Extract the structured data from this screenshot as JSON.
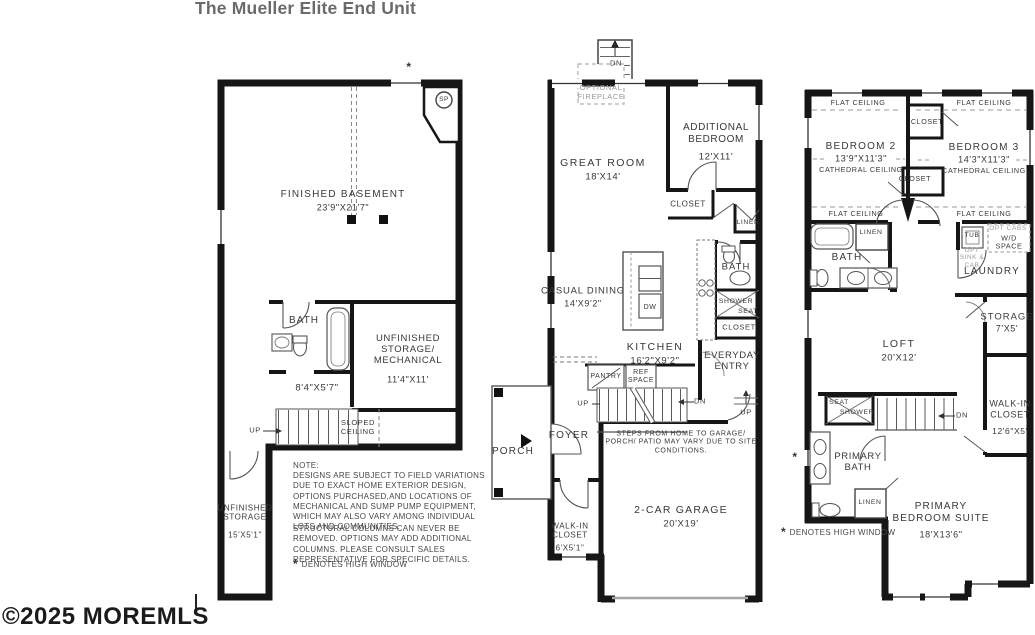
{
  "title": "The Mueller Elite End Unit",
  "watermark": "©2025 MOREMLS",
  "glyphs": {
    "arrow_right": "→",
    "arrow_left": "←",
    "arrow_up": "↑"
  },
  "colors": {
    "wall": "#161616",
    "label": "#383838",
    "muted_label": "#9a9a9a",
    "title": "#6b6b6b"
  },
  "basement": {
    "high_window_mark": "*",
    "sump_pump": "SP",
    "finished_name": "FINISHED BASEMENT",
    "finished_dims": "23'9\"X21'7\"",
    "bath": "BATH",
    "mech_name": "UNFINISHED STORAGE/ MECHANICAL",
    "mech_dims": "11'4\"X11'",
    "hall_dims": "8'4\"X5'7\"",
    "up": "UP",
    "sloped": "SLOPED CEILING",
    "strip_name": "UNFINISHED STORAGE",
    "strip_dims": "15'X5'1\""
  },
  "first_floor": {
    "deck_dn": "DN",
    "fireplace": "OPTIONAL FIREPLACE",
    "great_name": "GREAT ROOM",
    "great_dims": "18'X14'",
    "bed_name": "ADDITIONAL BEDROOM",
    "bed_dims": "12'X11'",
    "closet_bed": "CLOSET",
    "linen": "LINEN",
    "dining_name": "CASUAL DINING",
    "dining_dims": "14'X9'2\"",
    "dw": "DW",
    "kitchen_name": "KITCHEN",
    "kitchen_dims": "16'2\"X9'2\"",
    "bath": "BATH",
    "shower": "SHOWER",
    "seat": "SEAT",
    "closet_entry": "CLOSET",
    "entry_name": "EVERYDAY ENTRY",
    "pantry": "PANTRY",
    "ref": "REF SPACE",
    "up_stairs": "UP",
    "dn_stairs": "DN",
    "up_garage": "UP",
    "foyer": "FOYER",
    "porch": "PORCH",
    "steps_note": "STEPS FROM HOME TO GARAGE/ PORCH/ PATIO MAY VARY DUE TO SITE CONDITIONS.",
    "wic_name": "WALK-IN CLOSET",
    "wic_dims": "6'X5'1\"",
    "garage_name": "2-CAR GARAGE",
    "garage_dims": "20'X19'"
  },
  "second_floor": {
    "flat_ceiling": "FLAT CEILING",
    "closet_top": "CLOSET",
    "closet_mid": "CLOSET",
    "bed2_name": "BEDROOM 2",
    "bed2_dims": "13'9\"X11'3\"",
    "bed3_name": "BEDROOM 3",
    "bed3_dims": "14'3\"X11'3\"",
    "cathedral": "CATHEDRAL CEILING",
    "linen_hall": "LINEN",
    "bath": "BATH",
    "tub": "TUB",
    "opt_sink": "OPT SINK & CAB",
    "opt_cabs": "OPT CABS",
    "wd": "W/D SPACE",
    "laundry": "LAUNDRY",
    "storage_name": "STORAGE",
    "storage_dims": "7'X5'",
    "loft_name": "LOFT",
    "loft_dims": "20'X12'",
    "wic_name": "WALK-IN CLOSET",
    "wic_dims": "12'6\"X5'",
    "dn": "DN",
    "seat": "SEAT",
    "shower": "SHOWER",
    "pbath_name": "PRIMARY BATH",
    "linen_primary": "LINEN",
    "suite_name": "PRIMARY BEDROOM SUITE",
    "suite_dims": "18'X13'6\"",
    "high_window_mark": "*",
    "high_window_text": "DENOTES HIGH WINDOW"
  },
  "notes": {
    "heading": "NOTE:",
    "para1": "DESIGNS ARE SUBJECT TO FIELD VARIATIONS DUE TO EXACT HOME EXTERIOR DESIGN, OPTIONS PURCHASED,AND LOCATIONS OF MECHANICAL AND SUMP PUMP EQUIPMENT, WHICH MAY ALSO VARY AMONG INDIVIDUAL LOTS AND COMMUNITIES.",
    "para2": "STRUCTURAL COLUMNS CAN NEVER BE REMOVED. OPTIONS MAY ADD ADDITIONAL COLUMNS. PLEASE CONSULT SALES REPRESENTATIVE FOR SPECIFIC DETAILS.",
    "mark": "*",
    "high_window": "DENOTES HIGH WINDOW"
  }
}
